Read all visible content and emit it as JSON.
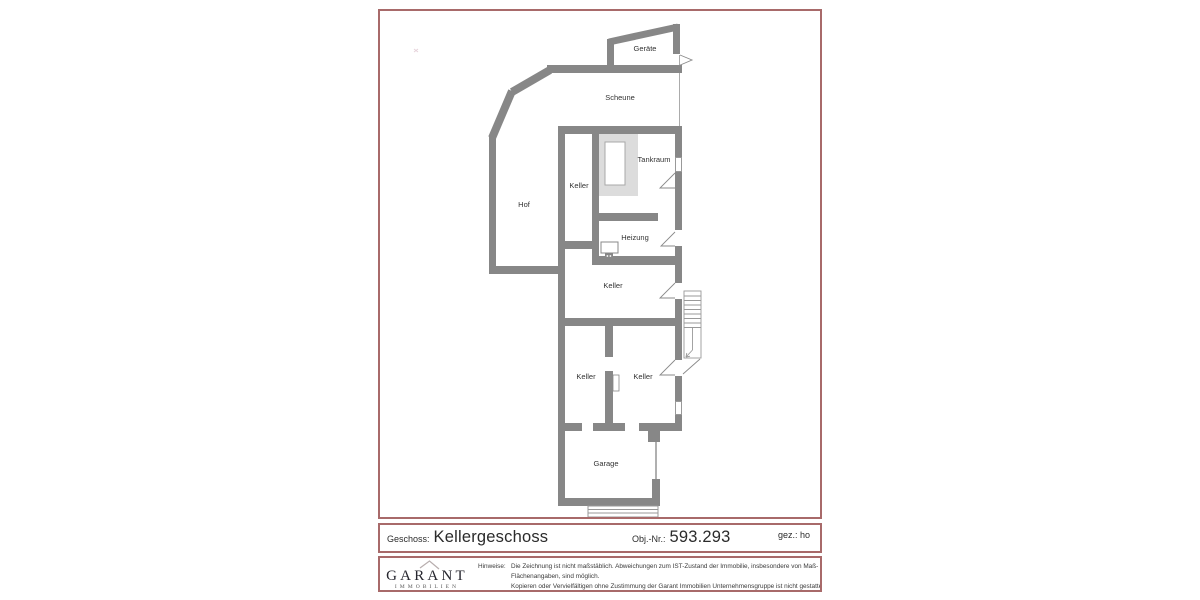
{
  "colors": {
    "frame_border": "#a86a6a",
    "wall_gray": "#878787",
    "label_text": "#333333"
  },
  "plan": {
    "labels": {
      "geraete": "Geräte",
      "scheune": "Scheune",
      "tankraum": "Tankraum",
      "keller_west": "Keller",
      "hof": "Hof",
      "heizung": "Heizung",
      "keller_mitte": "Keller",
      "keller_sued_west": "Keller",
      "keller_sued_ost": "Keller",
      "garage": "Garage"
    }
  },
  "title_block": {
    "geschoss_label": "Geschoss:",
    "geschoss_value": "Kellergeschoss",
    "obj_label": "Obj.-Nr.:",
    "obj_value": "593.293",
    "drawn_by": "gez.: ho"
  },
  "footer": {
    "brand_name": "GARANT",
    "brand_sub": "IMMOBILIEN",
    "notice_label": "Hinweise:",
    "notice_line1": "Die Zeichnung ist nicht maßstäblich. Abweichungen zum IST-Zustand der Immobilie, insbesondere von Maß- und",
    "notice_line2": "Flächenangaben, sind möglich.",
    "notice_line3": "Kopieren oder Vervielfältigen ohne Zustimmung der Garant Immobilien Unternehmensgruppe ist nicht gestattet!"
  }
}
